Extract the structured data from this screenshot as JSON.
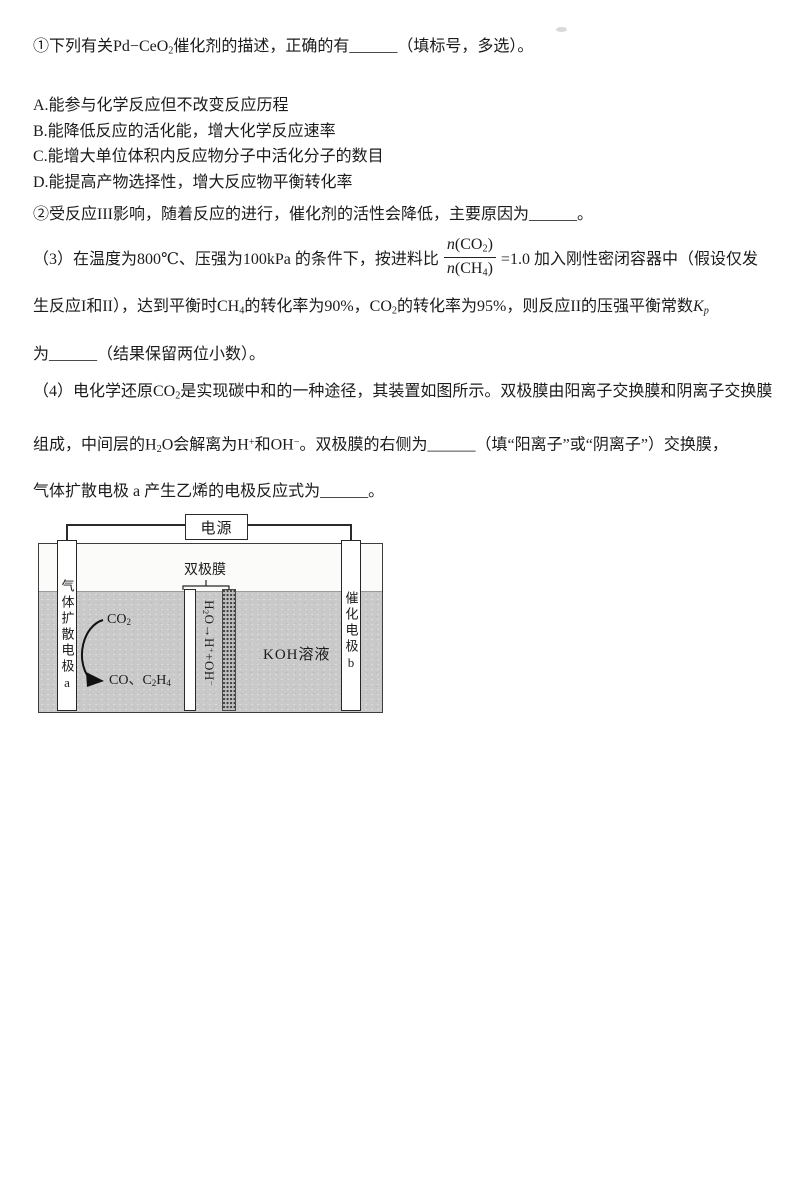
{
  "colors": {
    "text": "#1b1b1b",
    "liquid_gray": "#c9c9c9",
    "line": "#2f2f2f",
    "paper": "#ffffff"
  },
  "text": {
    "l1": {
      "a": "①下列有关",
      "f": "Pd−CeO",
      "f_sub": "2",
      "b": "催化剂的描述，正确的有",
      "blank": "______",
      "c": "（填标号，多选）。"
    },
    "options": [
      "A.能参与化学反应但不改变反应历程",
      "B.能降低反应的活化能，增大化学反应速率",
      "C.能增大单位体积内反应物分子中活化分子的数目",
      "D.能提高产物选择性，增大反应物平衡转化率"
    ],
    "l6": {
      "a": "②受反应III影响，随着反应的进行，催化剂的活性会降低，主要原因为",
      "blank": "______",
      "b": "。"
    },
    "l7": {
      "a": "（3）在温度为800℃、压强为100kPa 的条件下，按进料比",
      "frac": {
        "nn": "n",
        "no": "(CO",
        "ns": "2",
        "nc": ")",
        "dn": "n",
        "do": "(CH",
        "ds": "4",
        "dc": ")"
      },
      "b": "=1.0 加入刚性密闭容器中（假设仅发"
    },
    "l8": {
      "a": "生反应I和II），达到平衡时CH",
      "s1": "4",
      "b": "的转化率为90%，CO",
      "s2": "2",
      "c": "的转化率为95%，则反应II的压强平衡常数",
      "k": "K",
      "ks": "p"
    },
    "l9": {
      "a": "为",
      "blank": "______",
      "b": "（结果保留两位小数）。"
    },
    "l10": {
      "a": "（4）电化学还原CO",
      "s1": "2",
      "b": "是实现碳中和的一种途径，其装置如图所示。双极膜由阳离子交换膜和阴离子交换膜"
    },
    "l11": {
      "a": "组成，中间层的H",
      "s1": "2",
      "b": "O会解离为H",
      "p1": "+",
      "c": "和OH",
      "p2": "−",
      "d": "。双极膜的右侧为",
      "blank": "______",
      "e": "（填“阳离子”或“阴离子”）交换膜，"
    },
    "l12": {
      "a": "气体扩散电极 a 产生乙烯的电极反应式为",
      "blank": "______",
      "b": "。"
    }
  },
  "diagram": {
    "power": "电源",
    "membrane_label": "双极膜",
    "electrode_a": "气体扩散电极a",
    "electrode_b": "催化电极b",
    "co2": {
      "a": "CO",
      "s": "2"
    },
    "products": {
      "a": "CO、C",
      "s1": "2",
      "b": "H",
      "s2": "4"
    },
    "formula": {
      "a": "H",
      "s1": "2",
      "b": "O→H",
      "p1": "+",
      "c": "+OH",
      "p2": "−"
    },
    "solution": "KOH溶液"
  }
}
